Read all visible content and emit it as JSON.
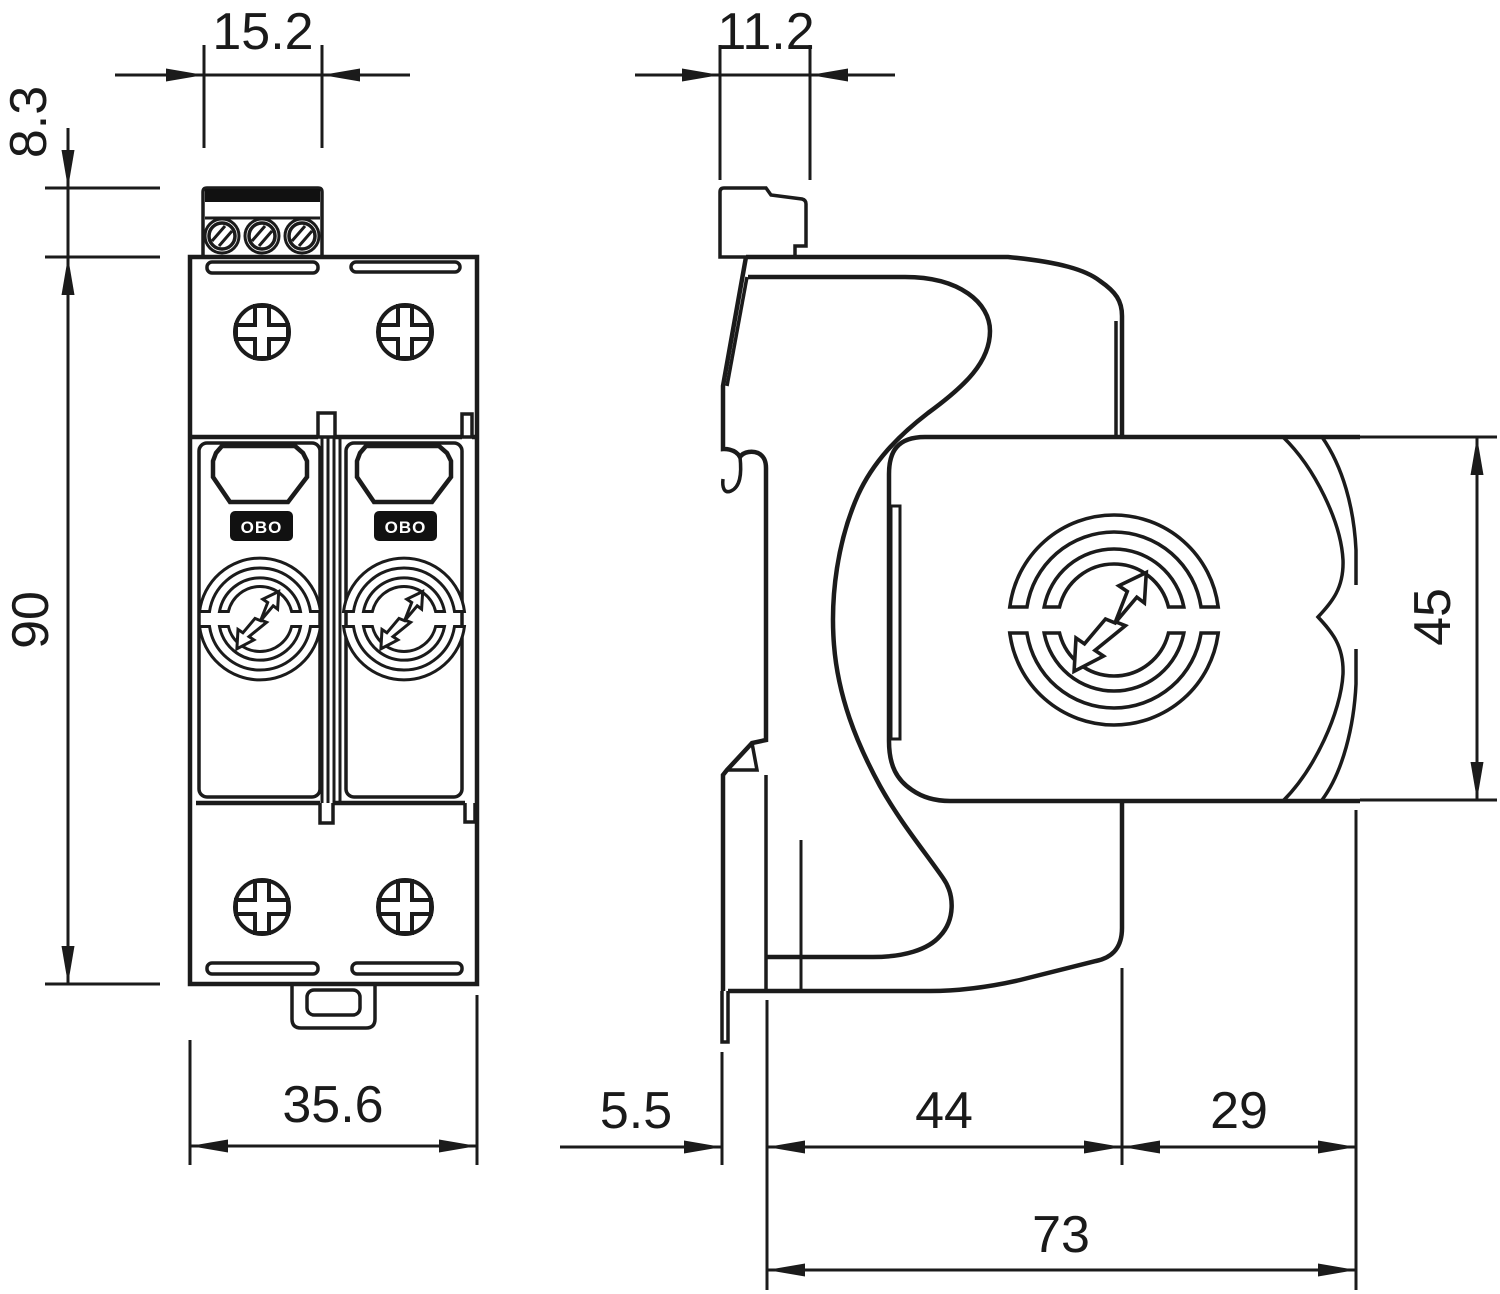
{
  "drawing": {
    "type": "technical-dimension-drawing",
    "product": "DIN-rail surge protection device, two views (front and side)",
    "logo_text": "OBO",
    "front_view": {
      "dim_terminal_width": "15.2",
      "dim_terminal_height": "8.3",
      "dim_body_height": "90",
      "dim_body_width": "35.6"
    },
    "side_view": {
      "dim_clip_width": "11.2",
      "dim_module_height": "45",
      "dim_rail_offset": "5.5",
      "dim_base_depth": "44",
      "dim_module_depth": "29",
      "dim_total_depth": "73"
    },
    "colors": {
      "line": "#1b1b1b",
      "background": "#ffffff"
    }
  }
}
